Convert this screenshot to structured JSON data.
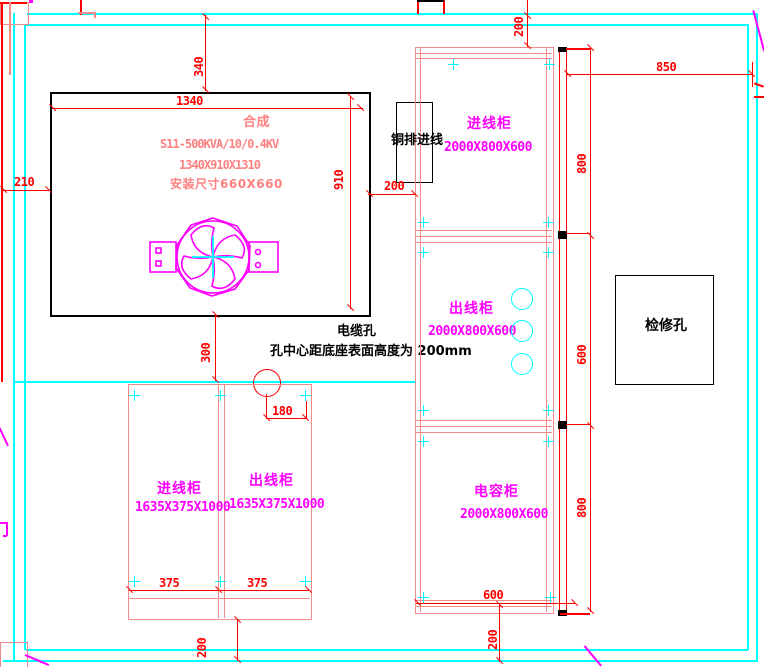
{
  "drawing": {
    "transformer": {
      "title": "合成",
      "model": "S11-500KVA/10/0.4KV",
      "dimensions": "1340X910X1310",
      "install": "安装尺寸660X660"
    },
    "busbar_inlet": "铜排进线",
    "cable_hole": {
      "label": "电缆孔",
      "note": "孔中心距底座表面高度为 200mm"
    },
    "inspection_hole": "检修孔",
    "right_cabinets": [
      {
        "name": "进线柜",
        "size": "2000X800X600"
      },
      {
        "name": "出线柜",
        "size": "2000X800X600"
      },
      {
        "name": "电容柜",
        "size": "2000X800X600"
      }
    ],
    "bottom_cabinets": [
      {
        "name": "进线柜",
        "size": "1635X375X1000"
      },
      {
        "name": "出线柜",
        "size": "1635X375X1000"
      }
    ],
    "dims": {
      "top": "340",
      "width": "1340",
      "left": "210",
      "depth": "910",
      "gap_bottom": "300",
      "busbar_gap": "200",
      "hole": "180",
      "top_right": "200",
      "right_wall": "850",
      "row1": "800",
      "row2": "600",
      "row3": "800",
      "col_width": "600",
      "bottom_right": "200",
      "panel_a": "375",
      "panel_b": "375",
      "bottom_left": "200"
    },
    "colors": {
      "frame": "#00ffff",
      "dimension": "#ff0000",
      "cabinet_outline": "#f28b8b",
      "label": "#ff00ff",
      "annotation": "#000000",
      "transformer_text": "#ff8080"
    }
  }
}
